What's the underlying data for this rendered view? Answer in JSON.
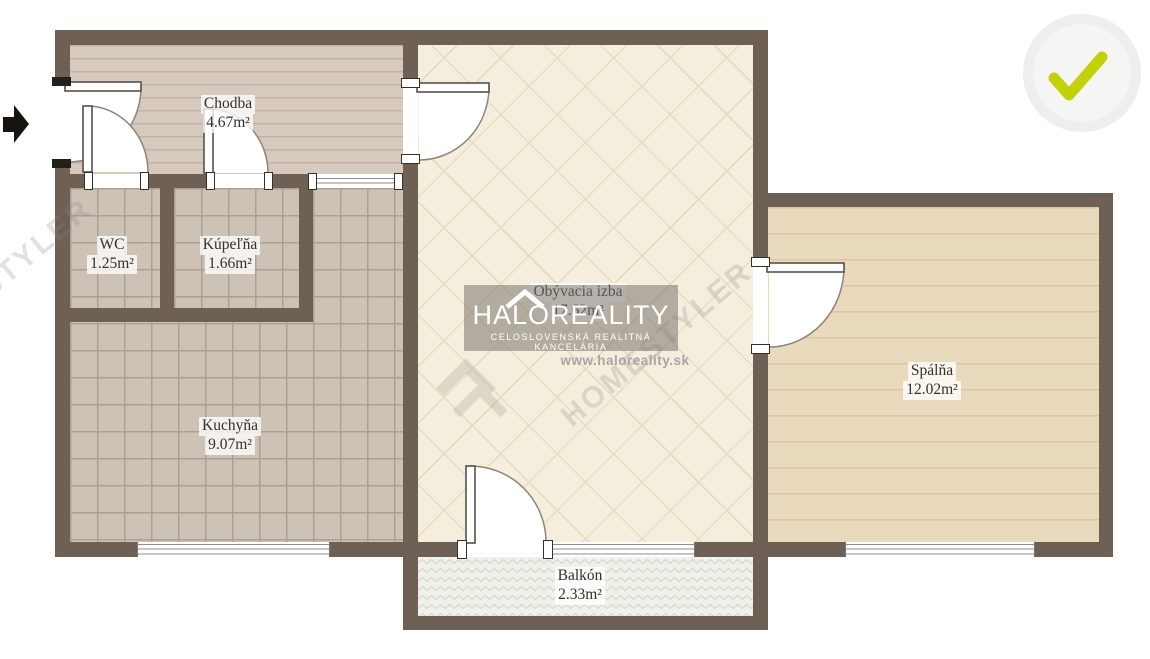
{
  "colors": {
    "wall": "#6e6054",
    "door_line": "#8d847a",
    "hall_floor": "#d6cabf",
    "hall_stripe": "#c2b3a9",
    "tile_floor": "#cdc2b6",
    "tile_line": "#af9f92",
    "living_floor": "#f5eedd",
    "living_line": "#e6dcc4",
    "bedroom_floor": "#e9dabd",
    "bedroom_stripe": "#dac7a5",
    "balcony_floor": "#f0f1eb",
    "balcony_zigzag": "#d6dacf",
    "label_text": "#33302b",
    "watermark_box": "rgba(122,117,110,0.55)",
    "watermark_text": "#ffffff",
    "url_text": "#a6a6a6",
    "faint_watermark": "rgba(135,135,135,0.25)",
    "check": "#c3d10b",
    "badge_bg": "#f3f3f2"
  },
  "rooms": [
    {
      "id": "chodba",
      "name": "Chodba",
      "area": "4.67m²"
    },
    {
      "id": "wc",
      "name": "WC",
      "area": "1.25m²"
    },
    {
      "id": "kupelna",
      "name": "Kúpeľňa",
      "area": "1.66m²"
    },
    {
      "id": "kuchyna",
      "name": "Kuchyňa",
      "area": "9.07m²"
    },
    {
      "id": "obyvacia",
      "name": "Obývacia izba",
      "area": "17.62m²"
    },
    {
      "id": "spalna",
      "name": "Spálňa",
      "area": "12.02m²"
    },
    {
      "id": "balkon",
      "name": "Balkón",
      "area": "2.33m²"
    }
  ],
  "watermark": {
    "brand": "HALOREALITY",
    "subtitle": "CELOSLOVENSKÁ REALITNÁ KANCELÁRIA",
    "url": "www.haloreality.sk",
    "diagonal": "HOMESTYLER"
  },
  "annotations": {
    "entrance_arrow": "right-arrow-icon",
    "verified_badge": "check-icon"
  }
}
